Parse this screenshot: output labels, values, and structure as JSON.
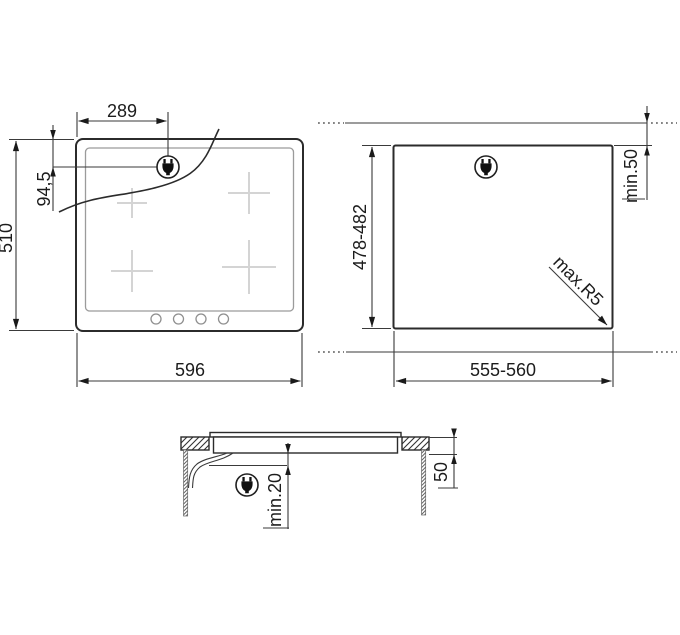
{
  "diagram": {
    "title": "hob-installation-drawing",
    "colors": {
      "line": "#2b2b2b",
      "background": "#ffffff",
      "zone_marks": "#d4d4d4"
    },
    "hob_view": {
      "plug_offset_x": "289",
      "plug_offset_y": "94,5",
      "depth": "510",
      "width": "596",
      "plug_icon": "power-plug",
      "controls_count": 4,
      "cooking_zones": 4
    },
    "cutout_view": {
      "depth": "478-482",
      "rear_wall_clearance": "min.50",
      "corner_radius": "max.R5",
      "width": "555-560",
      "plug_icon": "power-plug"
    },
    "section_view": {
      "clearance_below": "min.20",
      "recess_depth": "50",
      "plug_icon": "power-plug"
    }
  }
}
